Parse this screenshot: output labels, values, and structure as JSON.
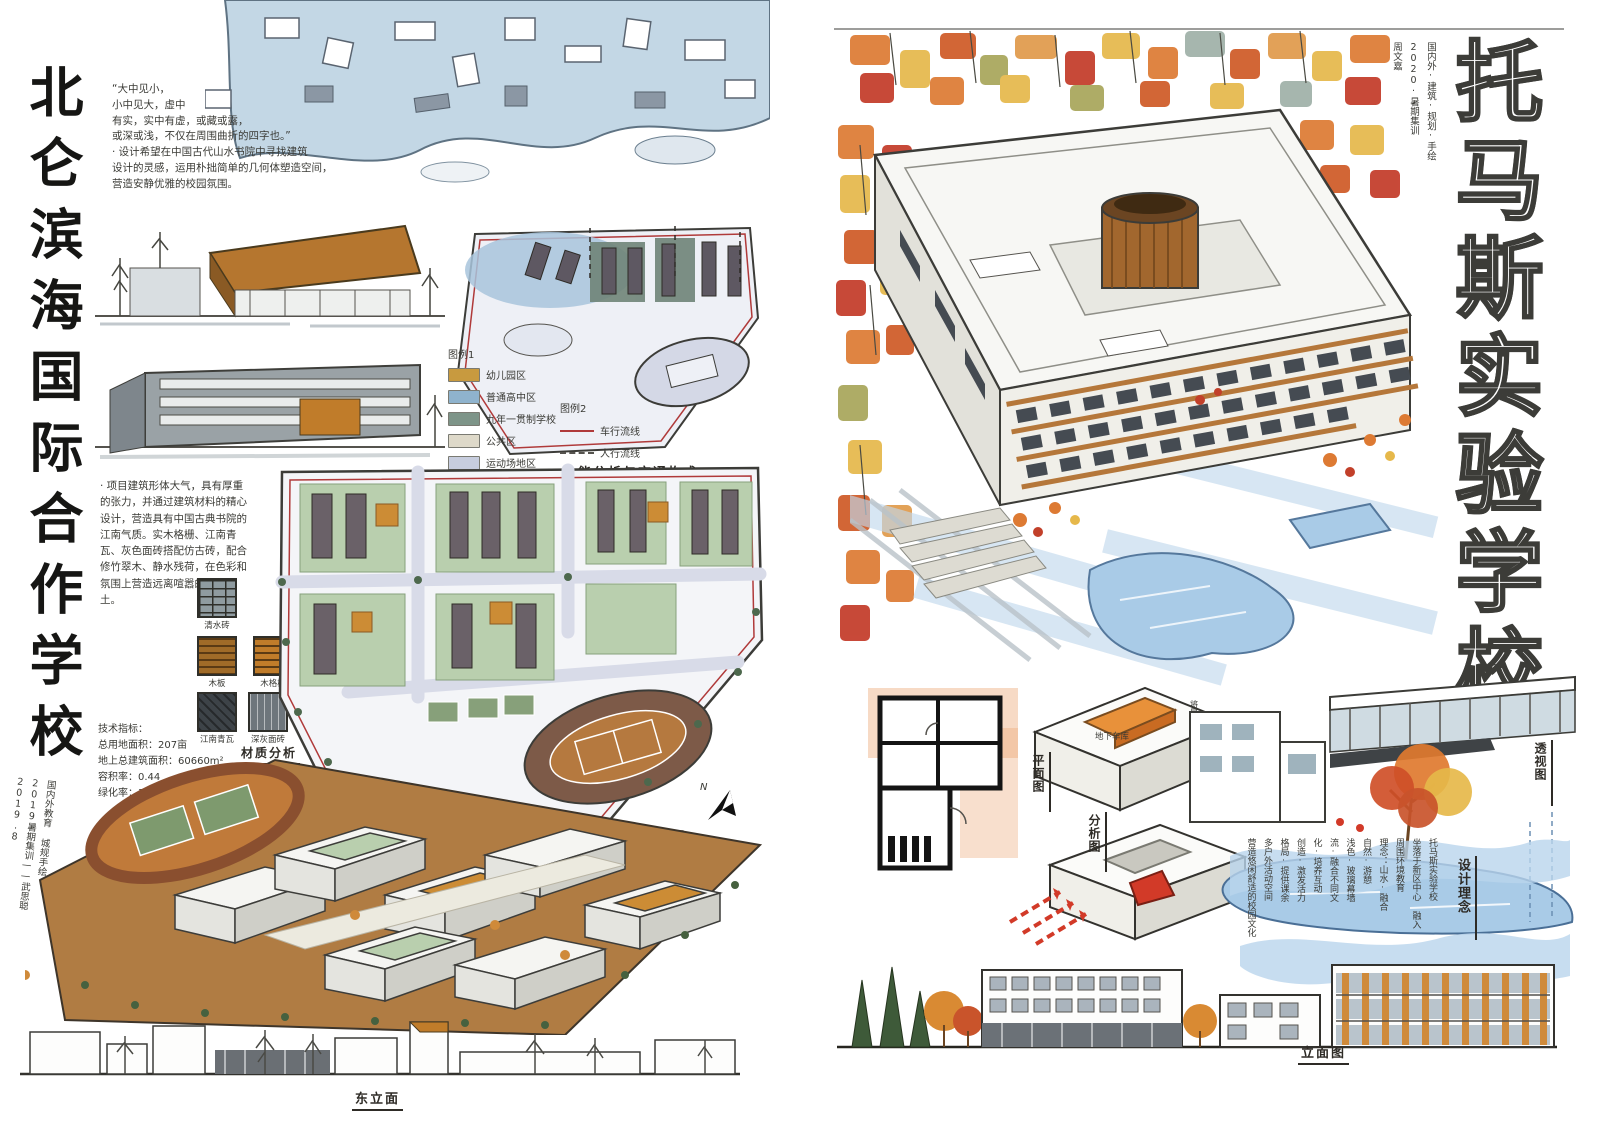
{
  "left_sheet": {
    "title": "北仑滨海国际合作学校",
    "quote": "“大中见小，\n小中见大，虚中\n有实，实中有虚，或藏或露，\n或深或浅，不仅在周围曲折的四字也。”\n· 设计希望在中国古代山水书院中寻找建筑\n设计的灵感，运用朴拙简单的几何体塑造空间，\n营造安静优雅的校园氛围。",
    "legend1_title": "图例1",
    "legend1": [
      {
        "label": "幼儿园区",
        "color": "#c89a3f"
      },
      {
        "label": "普通高中区",
        "color": "#8fb3cd"
      },
      {
        "label": "九年一贯制学校",
        "color": "#7d9488"
      },
      {
        "label": "公共区",
        "color": "#ded9c9"
      },
      {
        "label": "运动场地区",
        "color": "#c7cdde"
      }
    ],
    "legend2_title": "图例2",
    "legend2": [
      {
        "label": "车行流线",
        "color": "#b03a3a"
      },
      {
        "label": "人行流线",
        "color": "#55534e"
      }
    ],
    "function_caption": "功能分析与交通构成",
    "description": "· 项目建筑形体大气，具有厚重的张力，并通过建筑材料的精心设计，营造具有中国古典书院的江南气质。实木格栅、江南青瓦、灰色面砖搭配仿古砖，配合修竹翠木、静水残荷，在色彩和氛围上营造远离喧嚣的一方净土。",
    "tech": "技术指标：\n总用地面积：207亩\n地上总建筑面积：60660m²\n容积率：0.44\n绿化率：35%",
    "materials": [
      {
        "label": "清水砖",
        "color": "#8f9ba0"
      },
      {
        "label": "木板",
        "color": "#a06b28"
      },
      {
        "label": "木格栅",
        "color": "#c07c2a"
      },
      {
        "label": "江南青瓦",
        "color": "#3d4348"
      },
      {
        "label": "深灰面砖",
        "color": "#6e767c"
      },
      {
        "label": "浅灰面砖",
        "color": "#d8d4c4"
      }
    ],
    "material_caption": "材质分析",
    "plan_caption": "总平面",
    "north_label": "N",
    "elevation_caption": "东立面",
    "signature": "国内外教育 城规手绘\n2019暑期集训——武思聪\n2019.8"
  },
  "right_sheet": {
    "title": "托马斯实验学校",
    "credit": "国内外·建筑·规划·手绘\n2020·暑期集训\n周文嘉",
    "plan_caption": "平面图",
    "analysis_caption": "分析图",
    "perspective_caption": "透视图",
    "concept_caption": "设计理念",
    "elevation_caption": "立面图",
    "massing_note": "将量体向内凹陷",
    "basement_note": "地下车库",
    "concept_text": "托马斯实验学校\n坐落于新区中心 融入\n周围环境教育\n理念：山水·融合\n自然·游憩\n浅色·玻璃幕墙\n流·融合不同文\n化·培养互动\n创造·激发活力\n格局·提供课余\n多户外活动空间\n营造悠闲舒适的校园文化"
  },
  "palette": {
    "paper": "#ffffff",
    "wash_blue": "#c3d7e5",
    "marker_green": "#b9cfae",
    "marker_orange": "#cc8c35",
    "autumn_orange": "#dd7a33",
    "autumn_red": "#c33a28",
    "autumn_yellow": "#e6b84a",
    "ground_brown": "#b07c43",
    "water_blue": "#a9cbe7",
    "flow_red": "#b03a3a"
  }
}
